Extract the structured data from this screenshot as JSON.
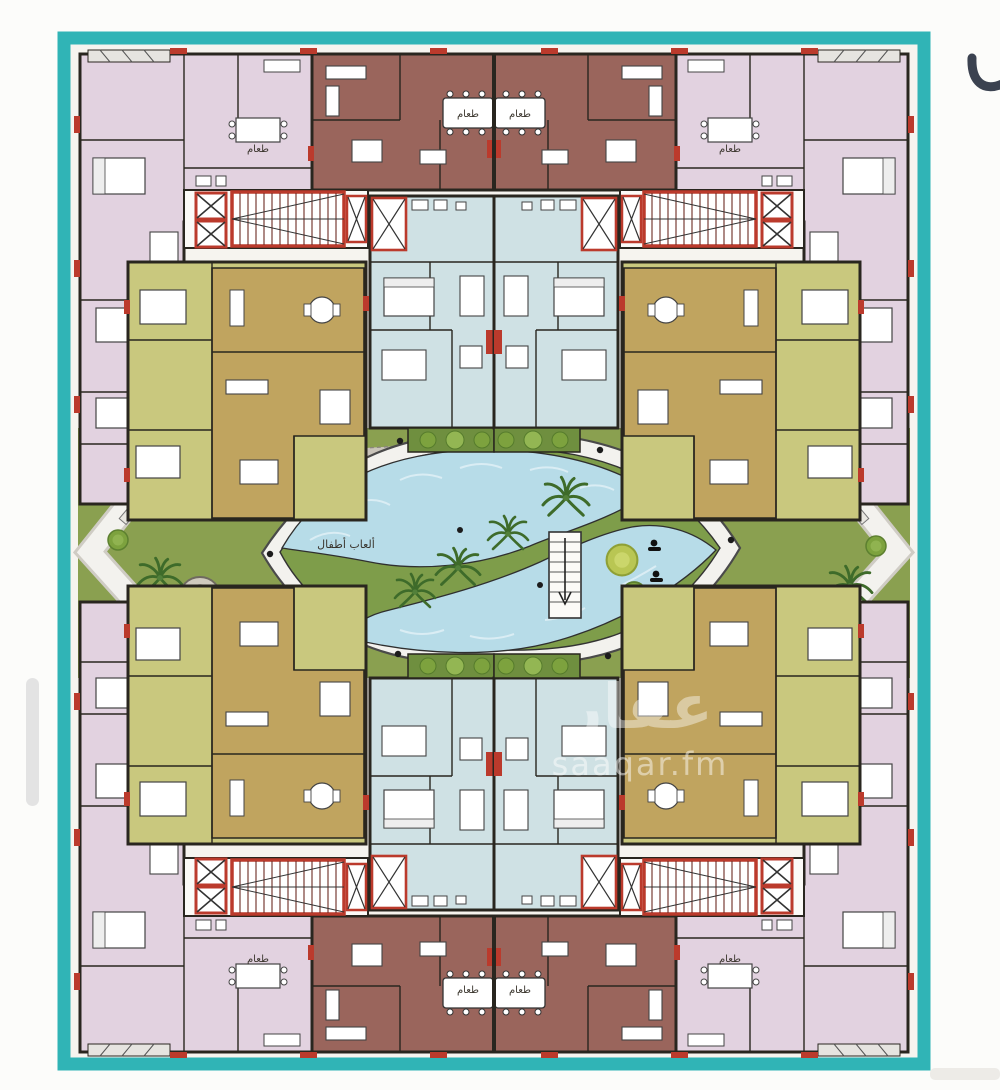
{
  "canvas": {
    "width": 1000,
    "height": 1086,
    "background": "#fcfcfa"
  },
  "frame": {
    "color": "#30b4b6"
  },
  "palette": {
    "plan_bg": "#f6f4ef",
    "pink_unit": "#e2d2e0",
    "brown_unit": "#9a655c",
    "blue_unit": "#cfe1e4",
    "olive_unit": "#c9c87e",
    "tan_unit": "#c0a45f",
    "wall": "#29261f",
    "red_accent": "#bb3a2c",
    "lawn": "#8aa050",
    "pool_water": "#b7dce8",
    "plaza_gray": "#c9c4ba",
    "deck_white": "#f3f2ee",
    "tree_green": "#3e6b2a",
    "bush_green": "#7da23e",
    "bush_yellow": "#b9c653"
  },
  "plan": {
    "labels": {
      "playground": "ألعاب أطفال",
      "dining": "طعام"
    },
    "watermark": {
      "logo": "عقار",
      "site": "saaqar.fm"
    }
  }
}
